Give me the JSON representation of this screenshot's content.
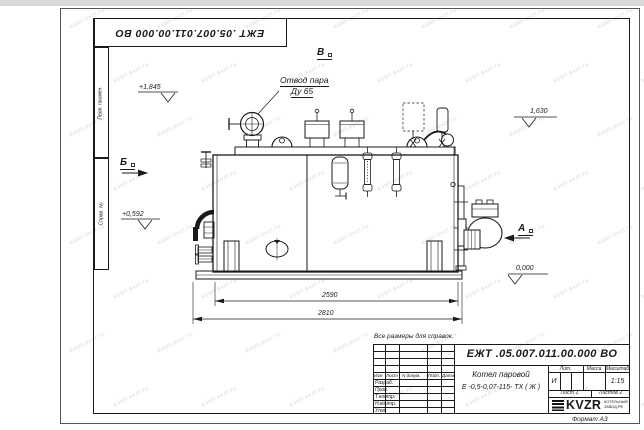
{
  "page": {
    "stamp_top": "ЕЖТ .05.007.011.00.000  ВО",
    "format_label": "Формат  А3",
    "note": "Все размеры для справок.",
    "side_labels": {
      "perv": "Перв. примен.",
      "sprav": "Справ. №"
    },
    "watermark": "kotel-kvzr.ru"
  },
  "drawing": {
    "labels": {
      "steam_outlet_line1": "Отвод пара",
      "steam_outlet_line2": "Ду 65",
      "view_a": "А",
      "view_b": "Б",
      "view_v": "В"
    },
    "elevations": {
      "e1845": "+1,845",
      "e1630": "1,630",
      "e0592": "+0,592",
      "e0000": "0,000"
    },
    "dims": {
      "d2590": "2590",
      "d2810": "2810"
    }
  },
  "title_block": {
    "designation": "ЕЖТ .05.007.011.00.000  ВО",
    "name_line1": "Котел паровой",
    "name_line2": "Е -0,5-0,07-115- ТХ ( Ж )",
    "header": {
      "izm": "Изм",
      "list": "Лист",
      "ndoc": "N докум.",
      "podp": "Подп.",
      "data": "Дата"
    },
    "rows": [
      "Разраб.",
      "Пров.",
      "Т.контр.",
      "Н.контр.",
      "Утв."
    ],
    "lit_header": "Лит.",
    "lit_value": "И",
    "mass_header": "Масса",
    "scale_header": "Масштаб",
    "scale_value": "1:15",
    "sheet_label": "Лист 1",
    "sheets_label": "Листов  2",
    "logo_text": "KVZR",
    "company_line1": "КОТЕЛЬНЫЙ",
    "company_line2": "ЗАВОД.РФ"
  }
}
